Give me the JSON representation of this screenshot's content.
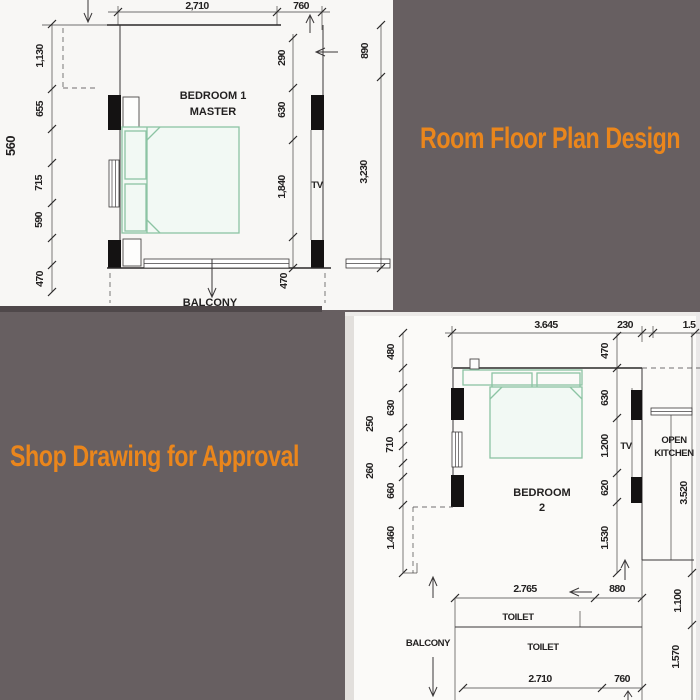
{
  "colors": {
    "background": "#675f61",
    "accent_orange": "#ea861c",
    "wall_ink": "#2b2929",
    "bed_green": "#8cc4a3"
  },
  "titles": {
    "main": "Room Floor Plan Design",
    "approval": "Shop Drawing for Approval"
  },
  "plan1": {
    "room_name_line1": "BEDROOM 1",
    "room_name_line2": "MASTER",
    "tv": "TV",
    "balcony": "BALCONY",
    "dims_top": [
      "2,710",
      "760"
    ],
    "dims_left": [
      "1,130",
      "655",
      "715",
      "590",
      "470"
    ],
    "dim_left_outer": "560",
    "dims_right_inner": [
      "290",
      "630",
      "1,840",
      "470"
    ],
    "dims_right_outer": [
      "890",
      "3,230"
    ]
  },
  "plan2": {
    "room_name_line1": "BEDROOM",
    "room_name_line2": "2",
    "tv": "TV",
    "kitchen_line1": "OPEN",
    "kitchen_line2": "KITCHEN",
    "balcony": "BALCONY",
    "toilet_upper": "TOILET",
    "toilet_lower": "TOILET",
    "dims_top": [
      "3.645",
      "230",
      "1.5"
    ],
    "dims_left": [
      "480",
      "630",
      "710",
      "660",
      "1.460"
    ],
    "dims_left_outer": [
      "250",
      "260"
    ],
    "dims_inner": [
      "470",
      "630",
      "1.200",
      "620",
      "1.530"
    ],
    "dim_kitchen": "3.520",
    "dims_right": [
      "1.100",
      "1.570"
    ],
    "dims_mid": [
      "2.765",
      "880"
    ],
    "dims_bottom": [
      "2.710",
      "760"
    ]
  }
}
